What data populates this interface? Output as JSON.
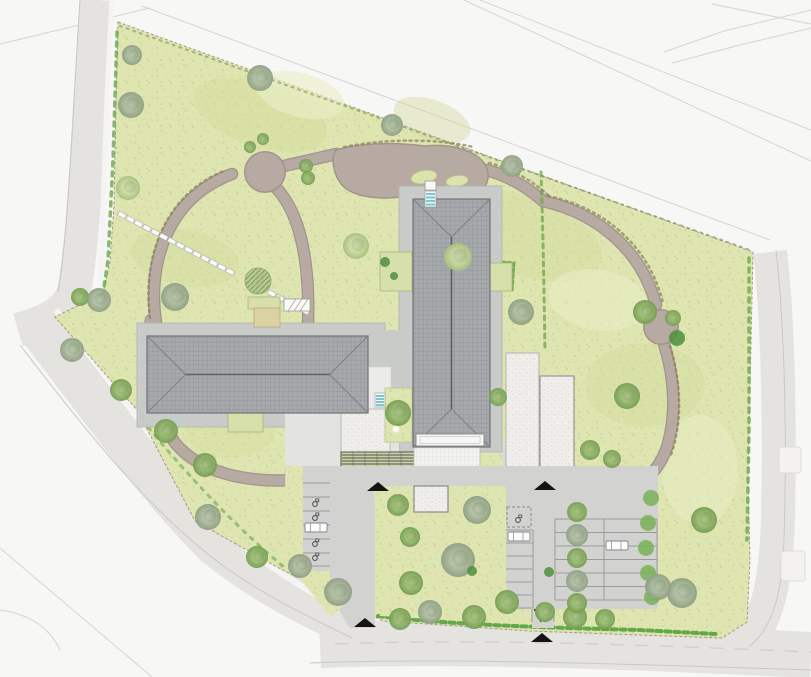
{
  "meta": {
    "type": "landscape-site-plan",
    "width": 811,
    "height": 677
  },
  "palette": {
    "background": "#f7f7f5",
    "road": "#e4e3e0",
    "road_edge": "#c9c8c4",
    "sidewalk": "#f5f4f2",
    "lawn": "#dfe5b1",
    "path_taupe": "#b7aaa3",
    "path_edge": "#a1948d",
    "apron": "#c9cbc8",
    "asphalt": "#d2d3d0",
    "stall_line": "#9b9c98",
    "roof": "#a6a9ac",
    "roof_line": "#6e7376",
    "gravel": "#f0efec",
    "hedge_green": "#6aa94c",
    "steps_teal": "#7fc6cf",
    "marker_black": "#141414",
    "tan_terrace": "#dbd2a4"
  },
  "features": {
    "lawn_mottles": [
      {
        "x": 260,
        "y": 115,
        "rx": 70,
        "ry": 32,
        "rot": 18,
        "c": "#d3dc9c",
        "o": 0.45
      },
      {
        "x": 520,
        "y": 235,
        "rx": 85,
        "ry": 40,
        "rot": 18,
        "c": "#d3dc9c",
        "o": 0.4
      },
      {
        "x": 185,
        "y": 258,
        "rx": 55,
        "ry": 28,
        "rot": 10,
        "c": "#d3dc9c",
        "o": 0.4
      },
      {
        "x": 645,
        "y": 385,
        "rx": 60,
        "ry": 42,
        "rot": 0,
        "c": "#d3dc9c",
        "o": 0.4
      },
      {
        "x": 300,
        "y": 95,
        "rx": 45,
        "ry": 22,
        "rot": 15,
        "c": "#e9eec6",
        "o": 0.6
      },
      {
        "x": 598,
        "y": 300,
        "rx": 50,
        "ry": 30,
        "rot": 10,
        "c": "#e9eec6",
        "o": 0.55
      },
      {
        "x": 432,
        "y": 120,
        "rx": 40,
        "ry": 20,
        "rot": 20,
        "c": "#cfd897",
        "o": 0.4
      },
      {
        "x": 700,
        "y": 470,
        "rx": 38,
        "ry": 55,
        "rot": 0,
        "c": "#e9eec6",
        "o": 0.5
      },
      {
        "x": 230,
        "y": 430,
        "rx": 45,
        "ry": 28,
        "rot": 0,
        "c": "#d3dc9c",
        "o": 0.35
      }
    ],
    "hedges": [
      {
        "name": "hedge-left-boundary",
        "d": "M117,32 L113,160 L108,260 L103,294",
        "w": 3.5,
        "dash": "4 6",
        "c": "#6aa94c",
        "o": 0.8
      },
      {
        "name": "hedge-right-boundary",
        "d": "M749,258 L749,430 L747,540",
        "w": 3.5,
        "dash": "4 6",
        "c": "#6aa94c",
        "o": 0.8
      },
      {
        "name": "hedge-bottom-strip",
        "d": "M378,616 C450,625 560,628 640,630 L716,634",
        "w": 4,
        "dash": "5 4",
        "c": "#55a23e",
        "o": 0.9
      },
      {
        "name": "hedge-southwest-edge",
        "d": "M142,420 C185,472 232,524 284,567",
        "w": 3,
        "dash": "3 7",
        "c": "#6aa94c",
        "o": 0.6
      },
      {
        "name": "hedge-interior-vertical",
        "d": "M541,172 C543,230 544,290 545,350",
        "w": 3,
        "dash": "4 5",
        "c": "#69a848",
        "o": 0.75
      },
      {
        "name": "hedge-court-side",
        "d": "M560,468 L642,470",
        "w": 3.5,
        "dash": "5 3",
        "c": "#69a848",
        "o": 0.85
      },
      {
        "name": "hedge-terrace-east",
        "d": "M490,261 L514,263 L512,292",
        "w": 3,
        "dash": "3 3",
        "c": "#6aa94c",
        "o": 0.9
      },
      {
        "name": "fence-ticks-top-boundary",
        "d": "M120,26 L750,250",
        "w": 2,
        "dash": "2 5",
        "c": "#7b8f57",
        "o": 0.6
      },
      {
        "name": "path-ticks-right-loop-a",
        "d": "M548,196 C606,208 650,248 663,303",
        "w": 2.5,
        "dash": "2 4",
        "c": "#8a7f5e",
        "o": 0.7
      },
      {
        "name": "path-ticks-right-loop-b",
        "d": "M670,346 C682,385 682,424 671,455",
        "w": 2.5,
        "dash": "2 4",
        "c": "#8a7f5e",
        "o": 0.7
      },
      {
        "name": "path-ticks-left-loop",
        "d": "M150,318 C142,258 164,194 226,170",
        "w": 2.5,
        "dash": "2 4",
        "c": "#8a7f5e",
        "o": 0.7
      },
      {
        "name": "path-ticks-top-blob",
        "d": "M344,147 C390,138 440,139 473,147",
        "w": 2.5,
        "dash": "2 4",
        "c": "#8a7f5e",
        "o": 0.7
      },
      {
        "name": "path-ticks-link",
        "d": "M489,163 C513,169 534,182 549,196",
        "w": 2.5,
        "dash": "2 4",
        "c": "#8a7f5e",
        "o": 0.7
      }
    ],
    "stepping_path": {
      "x1": 122,
      "y1": 215,
      "x2": 305,
      "y2": 311,
      "n": 22,
      "w": 8,
      "h": 4.4,
      "skip": [
        0.63,
        0.8
      ]
    },
    "path_islands": [
      {
        "x": 424,
        "y": 177,
        "rx": 13,
        "ry": 6.5,
        "rot": -10
      },
      {
        "x": 457,
        "y": 181,
        "rx": 11,
        "ry": 5.5,
        "rot": -8
      }
    ],
    "stall_groups": [
      {
        "name": "parking-west-column",
        "x1": 302,
        "x2": 330,
        "ys": [
          483,
          497,
          511,
          525,
          539,
          553,
          566
        ],
        "verts": [
          302
        ]
      },
      {
        "name": "parking-east-column-a",
        "x1": 506,
        "x2": 533,
        "ys": [
          530,
          543,
          556,
          569,
          582,
          595,
          608
        ],
        "verts": [
          533
        ]
      },
      {
        "name": "parking-east-columns-bc",
        "x1": 555,
        "x2": 657,
        "ys": [
          519,
          532.5,
          546,
          559.5,
          573,
          586.5,
          600
        ],
        "verts": [
          555,
          604,
          657
        ]
      }
    ],
    "accessible_icons": [
      [
        315,
        503
      ],
      [
        315,
        517
      ],
      [
        315,
        543
      ],
      [
        315,
        557
      ],
      [
        518,
        519
      ]
    ],
    "cars": [
      [
        305,
        523
      ],
      [
        508,
        532
      ],
      [
        606,
        541
      ]
    ],
    "entrance_markers": [
      {
        "cx": 378,
        "base": 491
      },
      {
        "cx": 545,
        "base": 490
      },
      {
        "cx": 365,
        "base": 627
      },
      {
        "cx": 542,
        "base": 642
      }
    ],
    "hedgerow_circles": [
      [
        651,
        498
      ],
      [
        648,
        523
      ],
      [
        646,
        548
      ],
      [
        648,
        573
      ],
      [
        652,
        597
      ]
    ],
    "trees": [
      [
        132,
        55,
        10,
        "G"
      ],
      [
        131,
        105,
        13,
        "G"
      ],
      [
        128,
        188,
        12,
        "L"
      ],
      [
        80,
        297,
        9,
        "g"
      ],
      [
        99,
        300,
        12,
        "G"
      ],
      [
        72,
        350,
        12,
        "G"
      ],
      [
        121,
        390,
        11,
        "g"
      ],
      [
        166,
        431,
        12,
        "g"
      ],
      [
        205,
        465,
        12,
        "g"
      ],
      [
        208,
        517,
        13,
        "G"
      ],
      [
        257,
        557,
        11,
        "g"
      ],
      [
        300,
        566,
        12,
        "G"
      ],
      [
        338,
        592,
        14,
        "G"
      ],
      [
        260,
        78,
        13,
        "G"
      ],
      [
        392,
        125,
        11,
        "G"
      ],
      [
        512,
        166,
        11,
        "G"
      ],
      [
        356,
        246,
        13,
        "L"
      ],
      [
        175,
        297,
        14,
        "G"
      ],
      [
        521,
        312,
        13,
        "G"
      ],
      [
        645,
        312,
        12,
        "g"
      ],
      [
        673,
        318,
        8,
        "g"
      ],
      [
        677,
        338,
        8,
        "d"
      ],
      [
        627,
        396,
        13,
        "g"
      ],
      [
        704,
        520,
        13,
        "g"
      ],
      [
        682,
        593,
        15,
        "G"
      ],
      [
        655,
        586,
        9,
        "g"
      ],
      [
        458,
        257,
        14,
        "L"
      ],
      [
        398,
        505,
        11,
        "g"
      ],
      [
        477,
        510,
        14,
        "G"
      ],
      [
        410,
        537,
        10,
        "g"
      ],
      [
        458,
        560,
        17,
        "G"
      ],
      [
        472,
        571,
        5,
        "d"
      ],
      [
        549,
        572,
        5,
        "d"
      ],
      [
        411,
        583,
        12,
        "g"
      ],
      [
        430,
        612,
        12,
        "G"
      ],
      [
        400,
        619,
        11,
        "g"
      ],
      [
        474,
        617,
        12,
        "g"
      ],
      [
        507,
        602,
        12,
        "g"
      ],
      [
        545,
        612,
        10,
        "g"
      ],
      [
        575,
        617,
        12,
        "g"
      ],
      [
        605,
        619,
        10,
        "g"
      ],
      [
        658,
        587,
        13,
        "G"
      ],
      [
        590,
        450,
        10,
        "g"
      ],
      [
        612,
        459,
        9,
        "g"
      ],
      [
        498,
        397,
        9,
        "g"
      ],
      [
        398,
        413,
        13,
        "g"
      ],
      [
        306,
        166,
        7,
        "g"
      ],
      [
        308,
        178,
        7,
        "g"
      ],
      [
        250,
        147,
        6,
        "g"
      ],
      [
        263,
        139,
        6,
        "g"
      ],
      [
        577,
        512,
        10,
        "g"
      ],
      [
        577,
        535,
        11,
        "G"
      ],
      [
        577,
        558,
        10,
        "g"
      ],
      [
        577,
        581,
        11,
        "G"
      ],
      [
        577,
        603,
        10,
        "g"
      ],
      [
        385,
        262,
        5,
        "d"
      ],
      [
        394,
        276,
        4,
        "d"
      ]
    ]
  }
}
